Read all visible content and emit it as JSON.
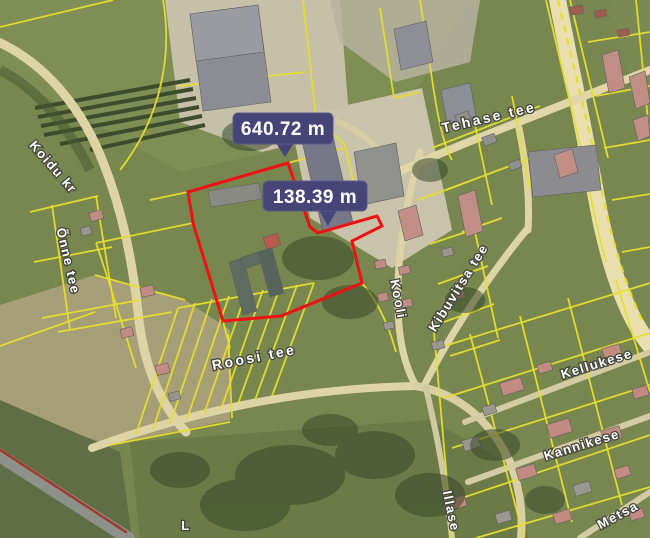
{
  "map": {
    "view": "satellite-cadastral",
    "measurements": {
      "total": "640.72 m",
      "segment": "138.39 m"
    },
    "streets": {
      "koidu": "Koidu kr",
      "onne": "Õnne tee",
      "tehase": "Tehase tee",
      "kooli": "Kooli",
      "kibuvitsa": "Kibuvitsa tee",
      "roosi": "Roosi tee",
      "kellukese": "Kellukese",
      "kannikese": "Kannikese",
      "illase": "Illase",
      "metsa": "Metsa",
      "partial": "L"
    },
    "colors": {
      "cadastral_line": "#e6dd2e",
      "selected_parcel": "#ee1111",
      "tooltip_bg": "#474578",
      "tooltip_border": "#5a588f",
      "street_label_text": "#ffffff"
    }
  }
}
